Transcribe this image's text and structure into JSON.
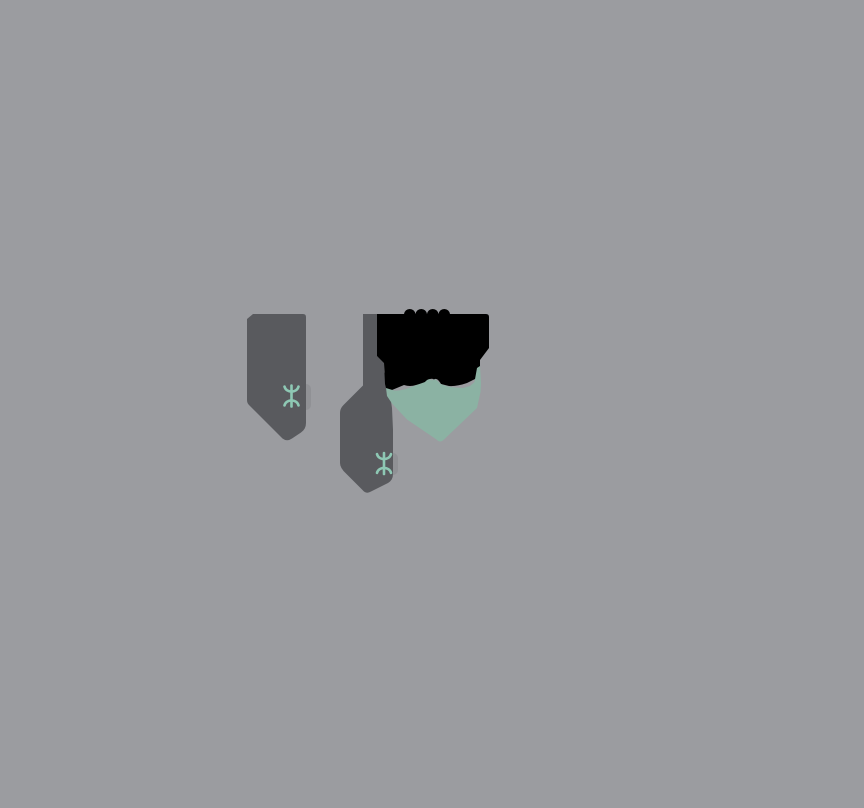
{
  "scene": {
    "width": 864,
    "height": 808
  },
  "colors": {
    "background": "#9b9ca0",
    "banner_gray": "#595a5e",
    "ink_black": "#000000",
    "teal_blot": "#8bb2a3",
    "icon_teal": "#8ec8b4",
    "notch_shadow": "#909195"
  },
  "icon": {
    "name": "mtr-logo",
    "bar_d": "M10 1.5 L10 22.5",
    "top_arc_d": "M3 2.6 C4.5 9.2 15.5 9.2 17 2.6",
    "bottom_arc_d": "M3 21.4 C4.5 14.8 15.5 14.8 17 21.4"
  },
  "shapes": {
    "left_banner_d": "M253 314 L303 314 Q306 314 306 317 L306 423 Q306 429 301 432.5 L292 438.5 Q287 442 282.5 438.5 L249 405 Q247 403 247 400 L247 319 Z",
    "middle_banner_d": "M363 314 L377 314 L377 356 L384 362.5 L384 372 L386.5 379 L388 386 L390.5 398 L392 408 L393 430 L393 474 Q393 480 388 483 L371 491.5 Q366 494.5 362.5 490 L346 473.5 Q340 468 340 463 L340 413 Q340 408.5 343.5 405 L363 385.5 Z",
    "ink_blot_d": "M377 314 L404 314 A5.8 5.8 0 0 1 415.5 314 A5.8 5.8 0 0 1 427 314 A5.8 5.8 0 0 1 438.5 314 A5.8 5.8 0 0 1 450 314 L486 314 Q489 314 489 317 L489 348 L480 360 L480 371 Q480 377 475 379 L467 383 Q457 386.5 449 386 L441 384 Q437 377 434 379.5 Q430 377 424 383 L416 385 Q410 387 404 385 L398 387.5 L392 390 L387 392 L385 384 L384 363 L377 356 Z",
    "teal_blot_d": "M386 388 L394 390.5 Q402 391 410 387.5 L418 384.5 L425 382 Q429 377.5 432 380.5 Q435 377.5 440 383.5 Q447 387 455 387.5 L463 388 L470 386 L474.5 382 L477 368 L480 366 L481 383 L480.5 392 L477 408 L444 439.5 Q440 443.5 436.5 439.5 L407 419.5 L392 403.5 L387 396 Z",
    "left_notch": {
      "x": 300,
      "y": 384,
      "w": 11,
      "h": 26,
      "r": 5
    },
    "middle_notch": {
      "x": 388,
      "y": 453,
      "w": 10,
      "h": 22,
      "r": 5
    }
  }
}
